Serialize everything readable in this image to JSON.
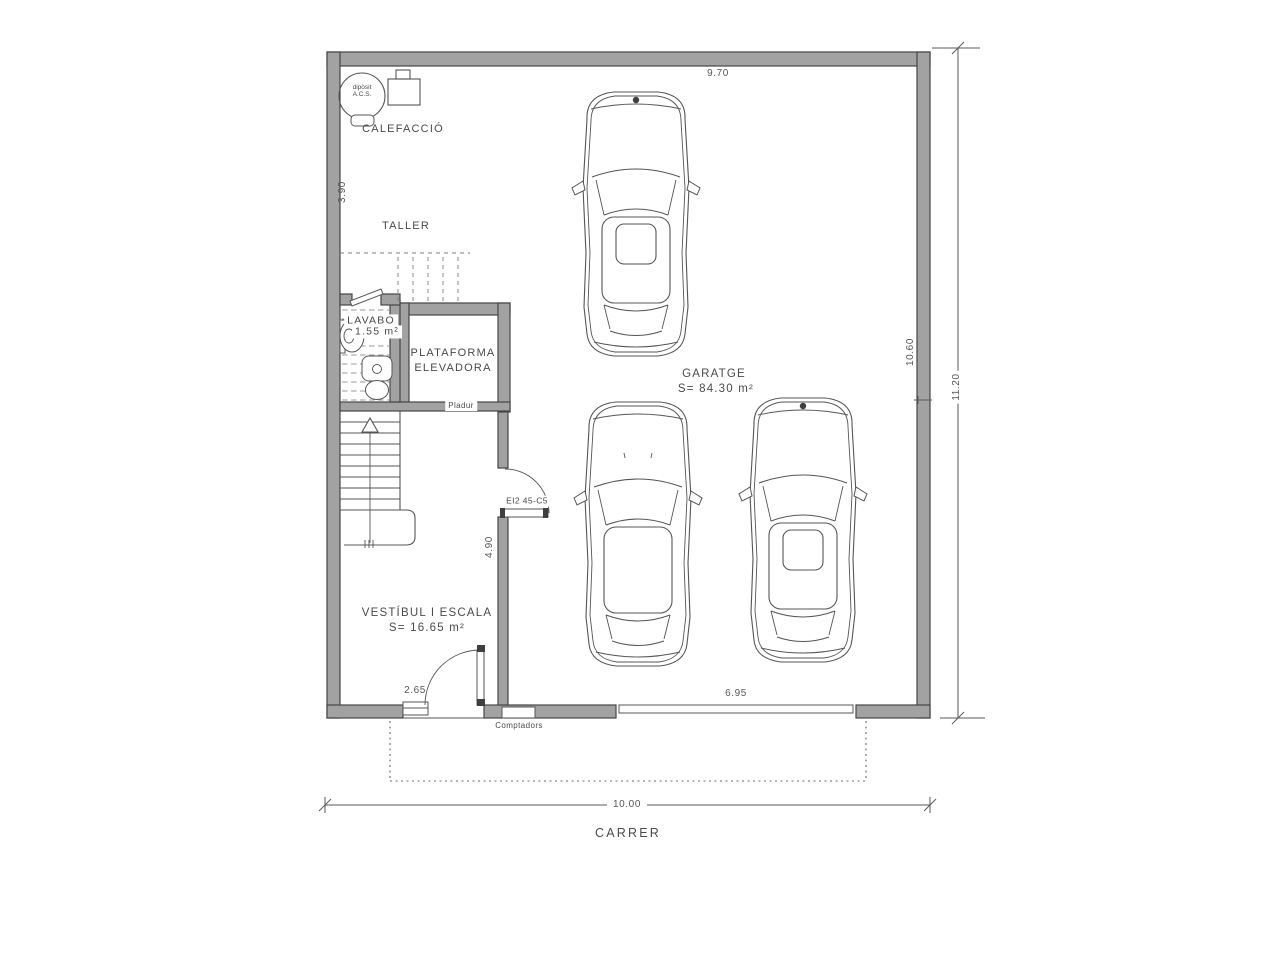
{
  "plan": {
    "rooms": {
      "calefaccio": {
        "label": "CALEFACCIÓ"
      },
      "taller": {
        "label": "TALLER"
      },
      "lavabo": {
        "label": "LAVABO",
        "area": "1.55 m²"
      },
      "plataforma": {
        "line1": "PLATAFORMA",
        "line2": "ELEVADORA"
      },
      "garatge": {
        "label": "GARATGE",
        "area": "S=  84.30  m²"
      },
      "vestibul": {
        "label": "VESTÍBUL I ESCALA",
        "area": "S=  16.65  m²"
      }
    },
    "annotations": {
      "pladur": "Pladur",
      "comptadors": "Comptadors",
      "fire_door": "EI2 45-C5",
      "street": "CARRER",
      "tank_line1": "dipòsit",
      "tank_line2": "A.C.S."
    },
    "dimensions": {
      "top_width": "9.70",
      "left_height": "3.90",
      "right_inner_height": "10.60",
      "right_total_height": "11.20",
      "vestibule_depth": "4.90",
      "entrance_width": "2.65",
      "garage_door_width": "6.95",
      "total_width": "10.00"
    },
    "colors": {
      "wall": "#a2a2a2",
      "wallstroke": "#454545",
      "line": "#555555",
      "text": "#4a4a4a",
      "bg": "#ffffff"
    }
  }
}
